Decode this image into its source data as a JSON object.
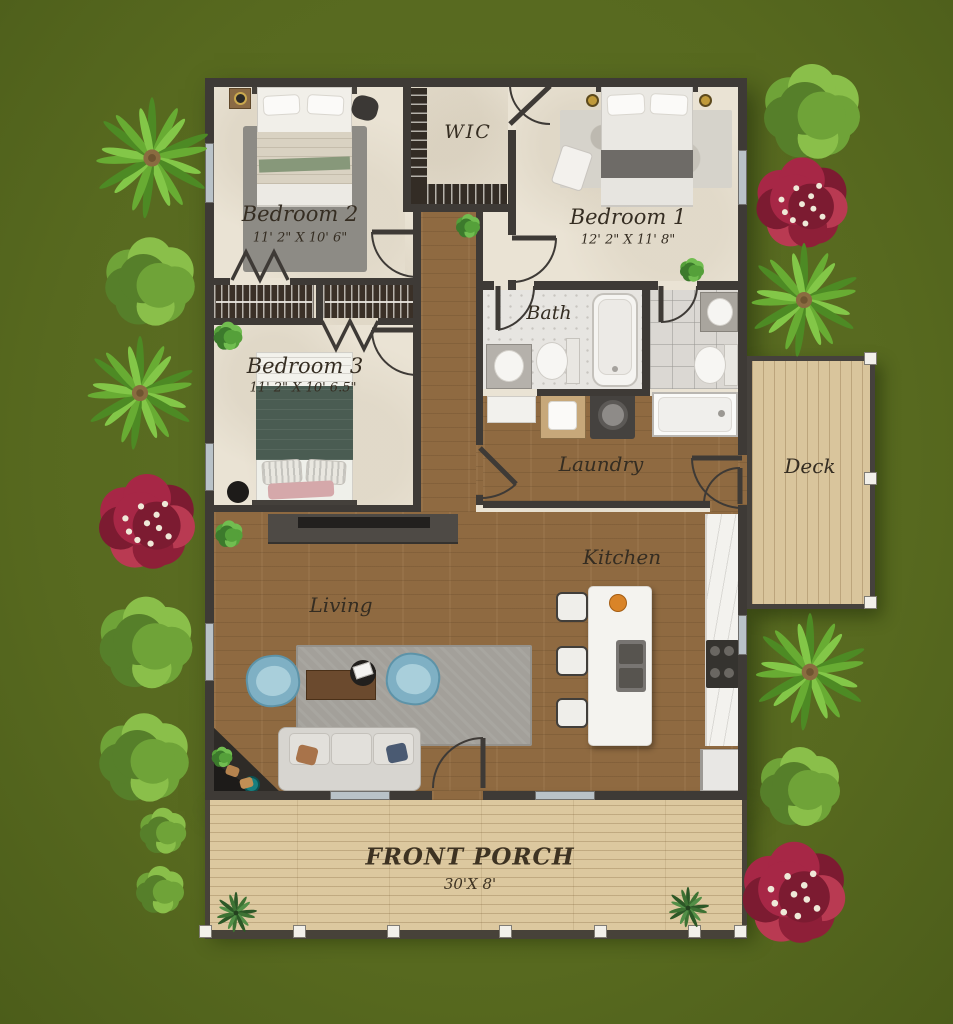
{
  "floorplan": {
    "rooms": {
      "bedroom2": {
        "label": "Bedroom 2",
        "dims": "11' 2\" X 10' 6\""
      },
      "bedroom1": {
        "label": "Bedroom 1",
        "dims": "12' 2\" X 11' 8\""
      },
      "bedroom3": {
        "label": "Bedroom 3",
        "dims": "11' 2\" X 10' 6.5\""
      },
      "wic": {
        "label": "WIC"
      },
      "bath": {
        "label": "Bath"
      },
      "laundry": {
        "label": "Laundry"
      },
      "kitchen": {
        "label": "Kitchen"
      },
      "living": {
        "label": "Living"
      },
      "deck": {
        "label": "Deck"
      },
      "front_porch": {
        "label": "FRONT PORCH",
        "dims": "30'X 8'"
      }
    },
    "colors": {
      "grass": "#57691f",
      "walls": "#3e3a36",
      "interior_wood": "#8f6a41",
      "bedroom_floor": "#eae3d4",
      "porch_wood": "#dcc89f",
      "deck_wood": "#d9c59c",
      "accent_chairs": "#7fb0c4",
      "flower_bush": "#a72746",
      "palm_green": "#68ac33"
    },
    "landscape": {
      "plants": [
        {
          "type": "palm",
          "x": 152,
          "y": 158,
          "r": 66
        },
        {
          "type": "bush",
          "x": 150,
          "y": 282,
          "r": 56
        },
        {
          "type": "palm",
          "x": 140,
          "y": 393,
          "r": 62
        },
        {
          "type": "flower",
          "x": 147,
          "y": 522,
          "r": 60
        },
        {
          "type": "bush",
          "x": 146,
          "y": 643,
          "r": 58
        },
        {
          "type": "bush",
          "x": 144,
          "y": 758,
          "r": 56
        },
        {
          "type": "bush",
          "x": 163,
          "y": 831,
          "r": 29
        },
        {
          "type": "bush",
          "x": 160,
          "y": 890,
          "r": 30
        },
        {
          "type": "bush",
          "x": 812,
          "y": 112,
          "r": 60
        },
        {
          "type": "flower",
          "x": 802,
          "y": 203,
          "r": 57
        },
        {
          "type": "palm",
          "x": 804,
          "y": 300,
          "r": 62
        },
        {
          "type": "palm",
          "x": 810,
          "y": 672,
          "r": 64
        },
        {
          "type": "bush",
          "x": 800,
          "y": 787,
          "r": 50
        },
        {
          "type": "flower",
          "x": 794,
          "y": 893,
          "r": 64
        },
        {
          "type": "shrub",
          "x": 236,
          "y": 913,
          "r": 24
        },
        {
          "type": "shrub",
          "x": 688,
          "y": 908,
          "r": 24
        },
        {
          "type": "houseplant",
          "x": 468,
          "y": 226,
          "r": 15
        },
        {
          "type": "houseplant",
          "x": 228,
          "y": 336,
          "r": 18
        },
        {
          "type": "houseplant",
          "x": 229,
          "y": 534,
          "r": 17
        },
        {
          "type": "houseplant",
          "x": 692,
          "y": 270,
          "r": 15
        },
        {
          "type": "houseplant",
          "x": 222,
          "y": 757,
          "r": 13
        }
      ]
    }
  }
}
